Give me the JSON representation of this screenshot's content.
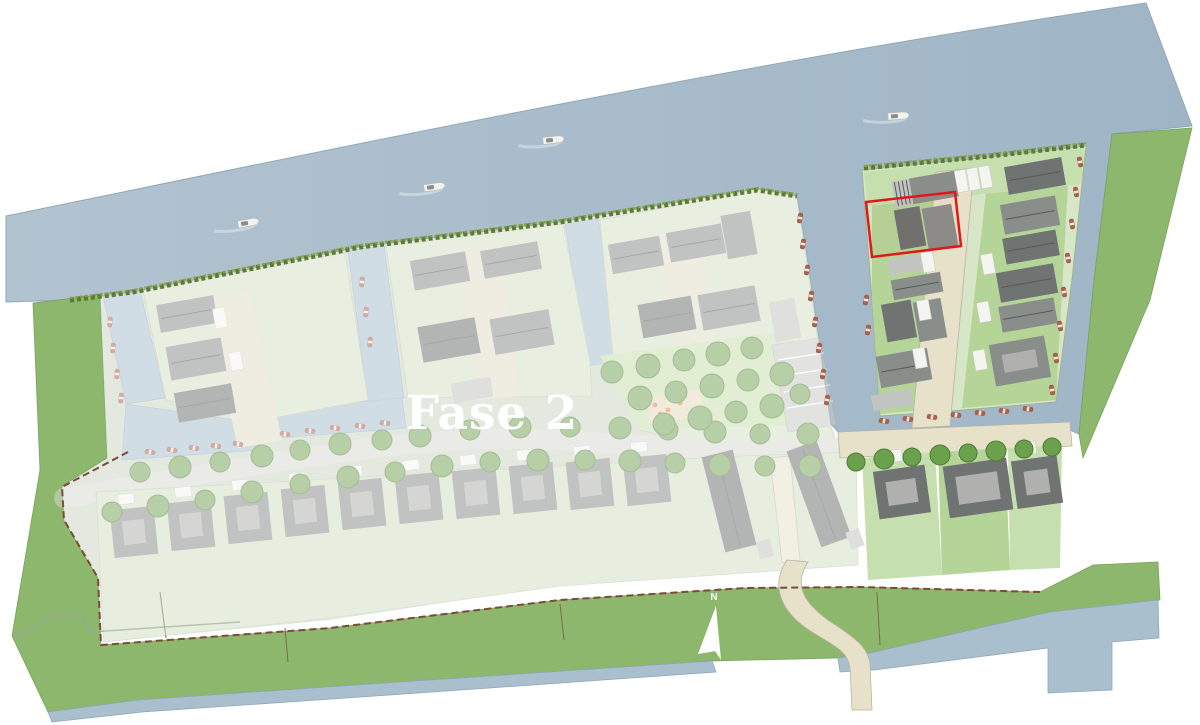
{
  "map": {
    "phase_label": "Fase 2",
    "compass_north_label": "N",
    "colors": {
      "page_bg": "#ffffff",
      "water": "#a9bfce",
      "grass": "#8cb76c",
      "island_base": "#d6e6c6",
      "road_bright": "#e8e1ca",
      "roof_dark": "#6f7371",
      "roof_mid": "#8a8e8b",
      "hedge": "#5c7a30",
      "highlight": "#e0181b",
      "boundary_dash": "#7c4a38",
      "moored_boat": "#b2604e"
    },
    "highlighted_plot": {
      "outline_color": "#e0181b"
    }
  },
  "scene": {
    "river_boats": [
      [
        247,
        223,
        -10
      ],
      [
        433,
        187,
        -8
      ],
      [
        552,
        140,
        -6
      ],
      [
        897,
        116,
        -4
      ]
    ],
    "moored_boats": {
      "bright": [
        [
          800,
          218,
          100
        ],
        [
          803,
          244,
          100
        ],
        [
          807,
          270,
          100
        ],
        [
          811,
          296,
          100
        ],
        [
          815,
          322,
          100
        ],
        [
          819,
          348,
          100
        ],
        [
          823,
          374,
          100
        ],
        [
          827,
          400,
          100
        ],
        [
          866,
          300,
          100
        ],
        [
          868,
          330,
          100
        ],
        [
          1080,
          162,
          80
        ],
        [
          1076,
          192,
          80
        ],
        [
          1072,
          224,
          80
        ],
        [
          1068,
          258,
          80
        ],
        [
          1064,
          292,
          80
        ],
        [
          1060,
          326,
          80
        ],
        [
          1056,
          358,
          80
        ],
        [
          1052,
          390,
          80
        ],
        [
          884,
          421,
          8
        ],
        [
          908,
          419,
          8
        ],
        [
          932,
          417,
          8
        ],
        [
          956,
          415,
          8
        ],
        [
          980,
          413,
          8
        ],
        [
          1004,
          411,
          8
        ],
        [
          1028,
          409,
          8
        ]
      ],
      "faded": [
        [
          150,
          452,
          10
        ],
        [
          172,
          450,
          10
        ],
        [
          194,
          448,
          10
        ],
        [
          216,
          446,
          10
        ],
        [
          238,
          444,
          10
        ],
        [
          285,
          434,
          8
        ],
        [
          310,
          431,
          8
        ],
        [
          335,
          428,
          8
        ],
        [
          360,
          426,
          8
        ],
        [
          385,
          423,
          8
        ],
        [
          110,
          322,
          95
        ],
        [
          113,
          348,
          95
        ],
        [
          117,
          374,
          95
        ],
        [
          121,
          398,
          95
        ],
        [
          362,
          282,
          95
        ],
        [
          366,
          312,
          95
        ],
        [
          370,
          342,
          95
        ]
      ]
    },
    "trees": {
      "faded": [
        [
          140,
          472,
          10
        ],
        [
          180,
          467,
          11
        ],
        [
          220,
          462,
          10
        ],
        [
          262,
          456,
          11
        ],
        [
          300,
          450,
          10
        ],
        [
          340,
          444,
          11
        ],
        [
          382,
          440,
          10
        ],
        [
          420,
          436,
          11
        ],
        [
          470,
          430,
          10
        ],
        [
          520,
          427,
          11
        ],
        [
          570,
          427,
          10
        ],
        [
          620,
          428,
          11
        ],
        [
          668,
          430,
          10
        ],
        [
          715,
          432,
          11
        ],
        [
          760,
          434,
          10
        ],
        [
          808,
          434,
          11
        ],
        [
          112,
          512,
          10
        ],
        [
          158,
          506,
          11
        ],
        [
          205,
          500,
          10
        ],
        [
          252,
          492,
          11
        ],
        [
          300,
          484,
          10
        ],
        [
          348,
          477,
          11
        ],
        [
          395,
          472,
          10
        ],
        [
          442,
          466,
          11
        ],
        [
          490,
          462,
          10
        ],
        [
          538,
          460,
          11
        ],
        [
          585,
          460,
          10
        ],
        [
          630,
          461,
          11
        ],
        [
          675,
          463,
          10
        ],
        [
          720,
          465,
          11
        ],
        [
          765,
          466,
          10
        ],
        [
          810,
          466,
          11
        ],
        [
          612,
          372,
          11
        ],
        [
          648,
          366,
          12
        ],
        [
          684,
          360,
          11
        ],
        [
          718,
          354,
          12
        ],
        [
          752,
          348,
          11
        ],
        [
          640,
          398,
          12
        ],
        [
          676,
          392,
          11
        ],
        [
          712,
          386,
          12
        ],
        [
          748,
          380,
          11
        ],
        [
          782,
          374,
          12
        ],
        [
          664,
          424,
          11
        ],
        [
          700,
          418,
          12
        ],
        [
          736,
          412,
          11
        ],
        [
          772,
          406,
          12
        ],
        [
          800,
          394,
          10
        ]
      ],
      "bright": [
        [
          856,
          462,
          9
        ],
        [
          884,
          459,
          10
        ],
        [
          912,
          457,
          9
        ],
        [
          940,
          455,
          10
        ],
        [
          968,
          453,
          9
        ],
        [
          996,
          451,
          10
        ],
        [
          1024,
          449,
          9
        ],
        [
          1052,
          447,
          9
        ]
      ]
    },
    "buildings": {
      "faded": [
        [
          158,
          300,
          58,
          28,
          -10,
          "mid"
        ],
        [
          168,
          342,
          56,
          34,
          -10,
          "mid"
        ],
        [
          176,
          388,
          58,
          30,
          -10,
          "dark"
        ],
        [
          214,
          308,
          12,
          20,
          -10,
          "white"
        ],
        [
          230,
          352,
          12,
          18,
          -10,
          "white"
        ],
        [
          412,
          256,
          56,
          30,
          -10,
          "mid"
        ],
        [
          482,
          246,
          58,
          28,
          -10,
          "mid"
        ],
        [
          420,
          322,
          58,
          36,
          -10,
          "dark"
        ],
        [
          492,
          314,
          60,
          36,
          -10,
          "mid"
        ],
        [
          452,
          380,
          40,
          20,
          -10,
          "light"
        ],
        [
          610,
          240,
          52,
          30,
          -10,
          "mid"
        ],
        [
          668,
          228,
          56,
          30,
          -10,
          "mid"
        ],
        [
          724,
          213,
          30,
          44,
          -10,
          "mid"
        ],
        [
          640,
          300,
          54,
          34,
          -10,
          "dark"
        ],
        [
          700,
          290,
          58,
          36,
          -10,
          "mid"
        ],
        [
          772,
          300,
          26,
          40,
          -10,
          "light"
        ],
        [
          112,
          508,
          44,
          48,
          -6,
          "mid"
        ],
        [
          169,
          501,
          44,
          48,
          -6,
          "mid"
        ],
        [
          226,
          494,
          44,
          48,
          -6,
          "mid"
        ],
        [
          283,
          487,
          44,
          48,
          -6,
          "mid"
        ],
        [
          340,
          480,
          44,
          48,
          -6,
          "mid"
        ],
        [
          397,
          474,
          44,
          48,
          -6,
          "mid"
        ],
        [
          454,
          469,
          44,
          48,
          -6,
          "mid"
        ],
        [
          511,
          464,
          44,
          48,
          -6,
          "mid"
        ],
        [
          568,
          460,
          44,
          48,
          -6,
          "mid"
        ],
        [
          625,
          456,
          44,
          48,
          -6,
          "mid"
        ],
        [
          118,
          494,
          16,
          10,
          -6,
          "white"
        ],
        [
          175,
          487,
          16,
          10,
          -6,
          "white"
        ],
        [
          232,
          480,
          16,
          10,
          -6,
          "white"
        ],
        [
          289,
          473,
          16,
          10,
          -6,
          "white"
        ],
        [
          346,
          466,
          16,
          10,
          -6,
          "white"
        ],
        [
          403,
          460,
          16,
          10,
          -6,
          "white"
        ],
        [
          460,
          455,
          16,
          10,
          -6,
          "white"
        ],
        [
          517,
          450,
          16,
          10,
          -6,
          "white"
        ],
        [
          574,
          446,
          16,
          10,
          -6,
          "white"
        ],
        [
          631,
          442,
          16,
          10,
          -6,
          "white"
        ],
        [
          680,
          485,
          98,
          32,
          76,
          "dark"
        ],
        [
          768,
          478,
          102,
          32,
          70,
          "dark"
        ],
        [
          756,
          542,
          18,
          14,
          76,
          "light"
        ],
        [
          846,
          532,
          18,
          14,
          70,
          "light"
        ]
      ],
      "bright": [
        [
          893,
          176,
          64,
          26,
          -10,
          "stripe"
        ],
        [
          897,
          208,
          26,
          40,
          -10,
          "dark"
        ],
        [
          925,
          206,
          30,
          42,
          -10,
          "mid"
        ],
        [
          888,
          256,
          42,
          16,
          -10,
          "light"
        ],
        [
          892,
          276,
          50,
          20,
          -10,
          "mid"
        ],
        [
          884,
          302,
          30,
          38,
          -10,
          "dark"
        ],
        [
          916,
          300,
          28,
          40,
          -10,
          "mid"
        ],
        [
          878,
          352,
          52,
          32,
          -10,
          "mid"
        ],
        [
          872,
          392,
          40,
          16,
          -10,
          "light"
        ],
        [
          1006,
          162,
          58,
          28,
          -10,
          "dark"
        ],
        [
          1002,
          200,
          56,
          30,
          -10,
          "mid"
        ],
        [
          1004,
          234,
          54,
          26,
          -10,
          "dark"
        ],
        [
          998,
          268,
          58,
          30,
          -10,
          "dark"
        ],
        [
          1000,
          302,
          56,
          26,
          -10,
          "mid"
        ],
        [
          992,
          340,
          56,
          42,
          -10,
          "mid"
        ],
        [
          956,
          170,
          11,
          22,
          -10,
          "white"
        ],
        [
          968,
          168,
          11,
          22,
          -10,
          "white"
        ],
        [
          980,
          166,
          11,
          22,
          -10,
          "white"
        ],
        [
          922,
          252,
          12,
          20,
          -10,
          "white"
        ],
        [
          918,
          300,
          12,
          20,
          -10,
          "white"
        ],
        [
          914,
          348,
          12,
          20,
          -10,
          "white"
        ],
        [
          982,
          254,
          12,
          20,
          -10,
          "white"
        ],
        [
          978,
          302,
          12,
          20,
          -10,
          "white"
        ],
        [
          974,
          350,
          12,
          20,
          -10,
          "white"
        ],
        [
          876,
          468,
          52,
          48,
          -8,
          "dark"
        ],
        [
          946,
          462,
          64,
          52,
          -8,
          "dark"
        ],
        [
          1014,
          458,
          46,
          48,
          -8,
          "dark"
        ],
        [
          886,
          450,
          16,
          12,
          -8,
          "white"
        ],
        [
          958,
          446,
          16,
          12,
          -8,
          "white"
        ],
        [
          1020,
          442,
          16,
          12,
          -8,
          "white"
        ]
      ]
    }
  }
}
